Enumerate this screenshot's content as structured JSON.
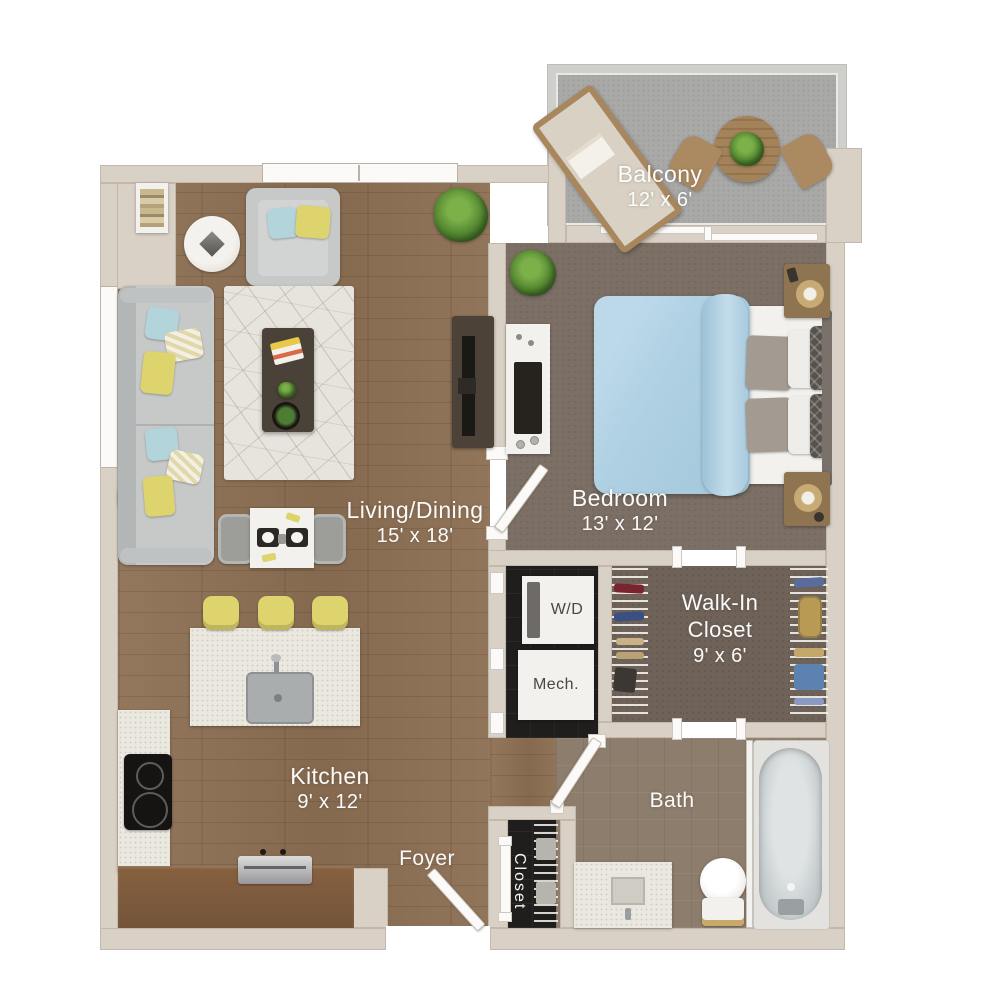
{
  "rooms": {
    "balcony": {
      "name": "Balcony",
      "dims": "12' x 6'"
    },
    "living": {
      "name": "Living/Dining",
      "dims": "15' x 18'"
    },
    "bedroom": {
      "name": "Bedroom",
      "dims": "13' x 12'"
    },
    "walkin": {
      "name": "Walk-In Closet",
      "dims": "9' x 6'"
    },
    "kitchen": {
      "name": "Kitchen",
      "dims": "9' x 12'"
    },
    "foyer": {
      "name": "Foyer"
    },
    "bath": {
      "name": "Bath"
    },
    "entry_closet": {
      "name": "Closet"
    },
    "laundry": {
      "name": "W/D"
    },
    "mechanical": {
      "name": "Mech."
    }
  },
  "colors": {
    "wall": "#d9d1c5",
    "wood_floor": "#8d7054",
    "bedroom_carpet": "#7c6f65",
    "closet_carpet": "#6e6259",
    "balcony_floor": "#a9a9a7",
    "bath_tile": "#8d7d6c",
    "utility_tile": "#201e1c",
    "counter": "#ebe8e0",
    "label_text": "#ffffff",
    "accent_yellow": "#ddd46d",
    "accent_blue": "#b4d4dc",
    "duvet_blue": "#aed0e2"
  }
}
